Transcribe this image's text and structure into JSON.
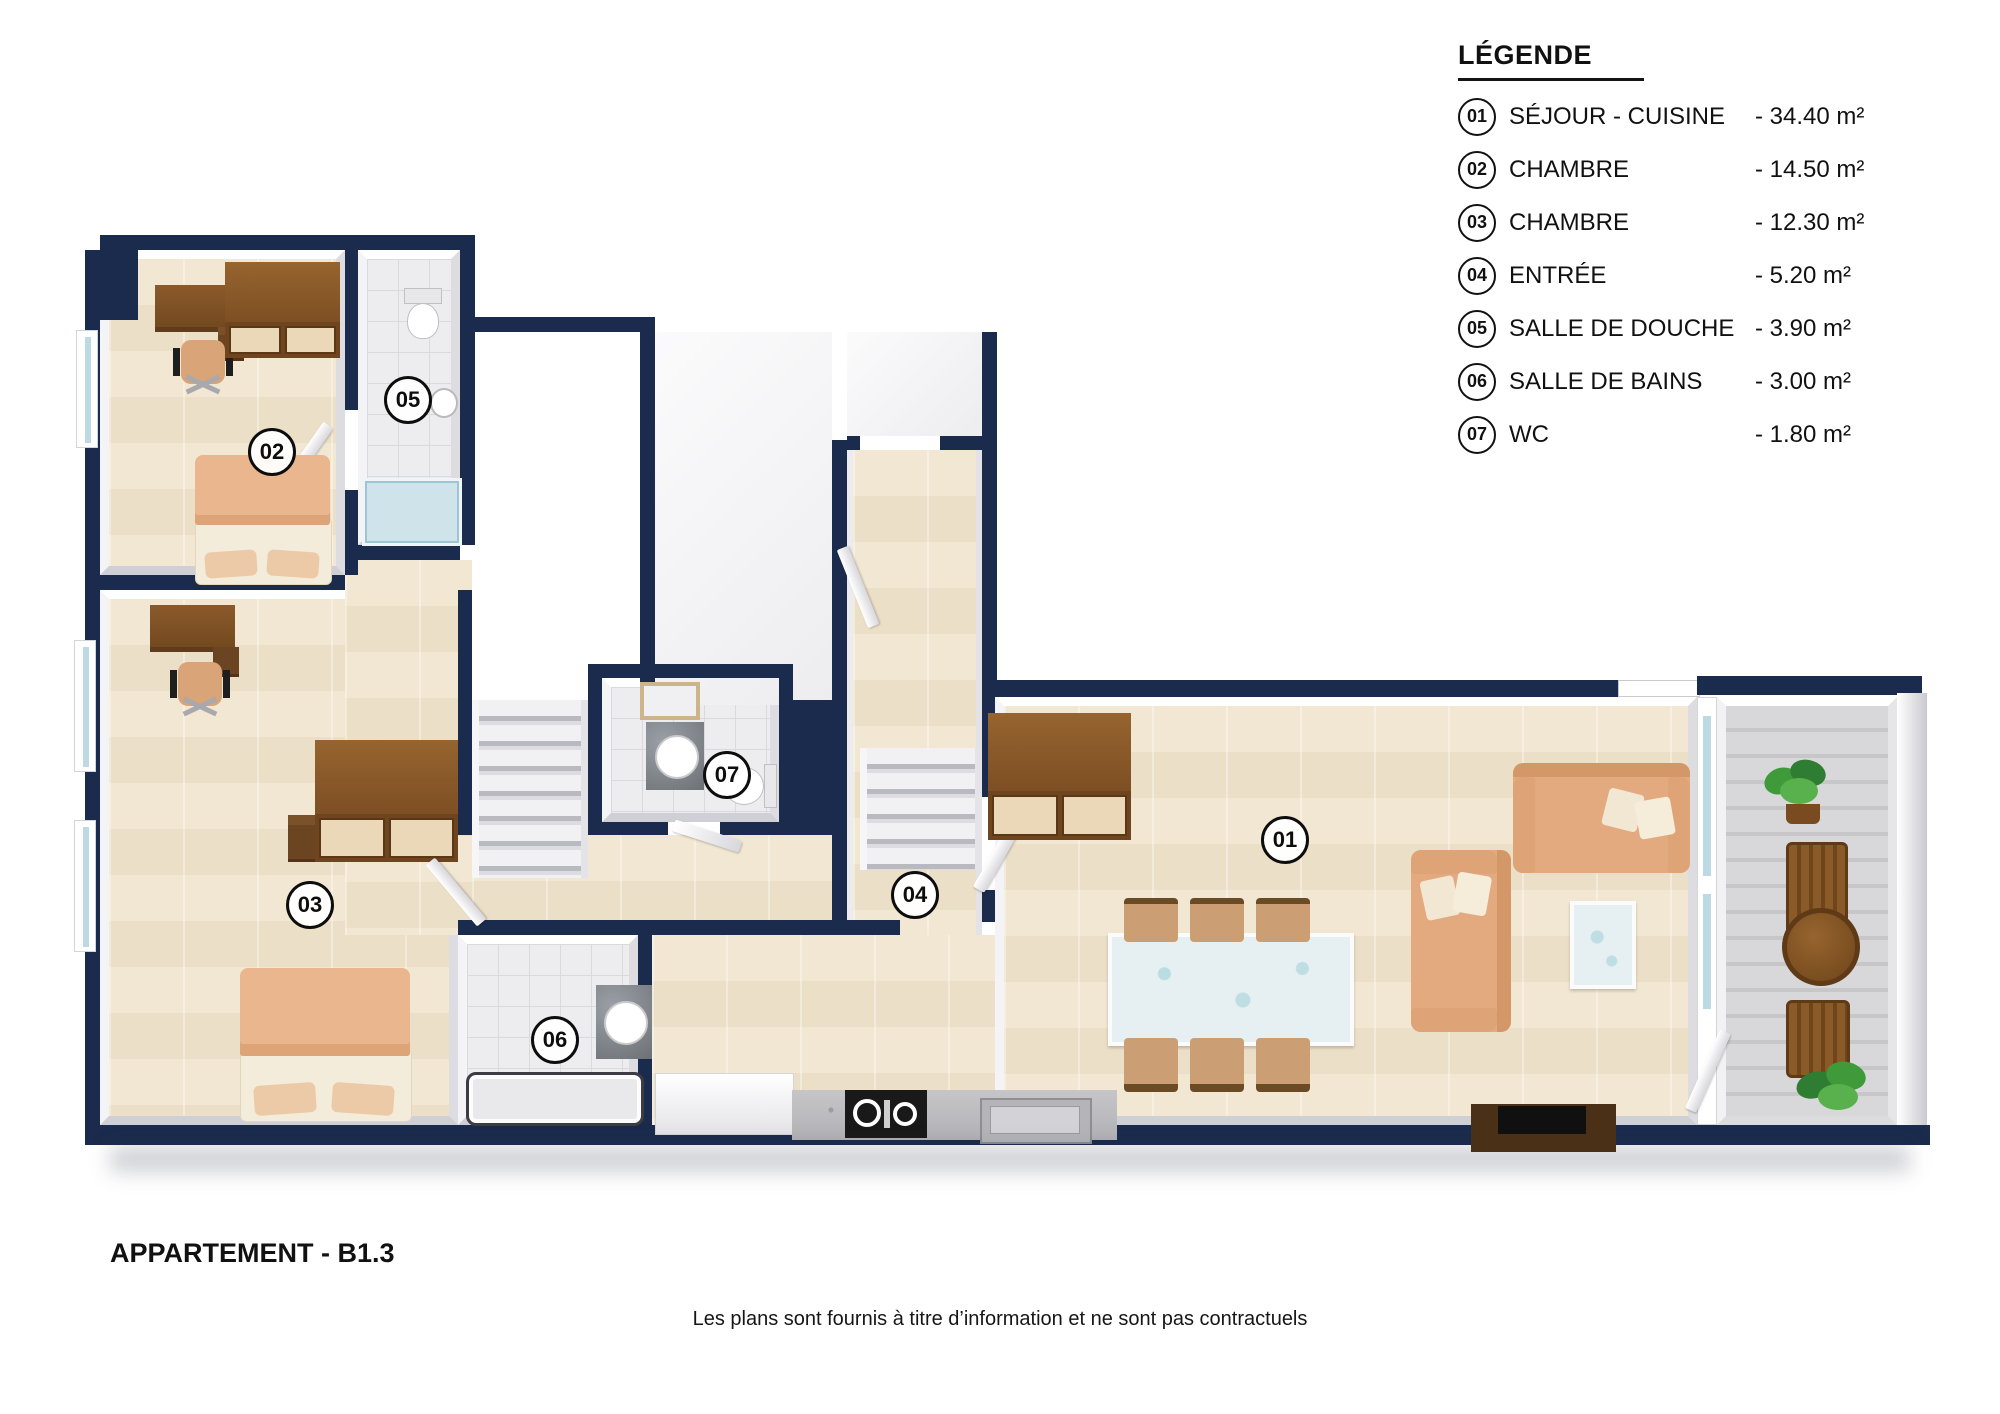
{
  "page": {
    "title": "APPARTEMENT - B1.3",
    "disclaimer": "Les plans sont fournis à titre d’information et ne sont pas contractuels"
  },
  "legend": {
    "title": "LÉGENDE",
    "items": [
      {
        "num": "01",
        "label": "SÉJOUR - CUISINE",
        "area": "- 34.40 m²"
      },
      {
        "num": "02",
        "label": "CHAMBRE",
        "area": "- 14.50 m²"
      },
      {
        "num": "03",
        "label": "CHAMBRE",
        "area": "- 12.30 m²"
      },
      {
        "num": "04",
        "label": "ENTRÉE",
        "area": "- 5.20 m²"
      },
      {
        "num": "05",
        "label": "SALLE DE DOUCHE",
        "area": "- 3.90 m²"
      },
      {
        "num": "06",
        "label": "SALLE DE BAINS",
        "area": "- 3.00 m²"
      },
      {
        "num": "07",
        "label": "WC",
        "area": "- 1.80 m²"
      }
    ]
  },
  "plan": {
    "badges": [
      {
        "num": "01",
        "x": 1285,
        "y": 840
      },
      {
        "num": "02",
        "x": 272,
        "y": 452
      },
      {
        "num": "03",
        "x": 310,
        "y": 905
      },
      {
        "num": "04",
        "x": 915,
        "y": 895
      },
      {
        "num": "05",
        "x": 408,
        "y": 400
      },
      {
        "num": "06",
        "x": 555,
        "y": 1040
      },
      {
        "num": "07",
        "x": 727,
        "y": 775
      }
    ]
  },
  "colors": {
    "wall": "#1a2b4d",
    "wood_floor": "#f0e4d0",
    "tile_floor": "#ededf0",
    "furniture_brown": "#8a5a2b",
    "sofa_tan": "#e3aa80",
    "glass_blue": "#cfe4ea",
    "deck_gray": "#d4d4d6",
    "plant_green": "#3f9b3a"
  }
}
